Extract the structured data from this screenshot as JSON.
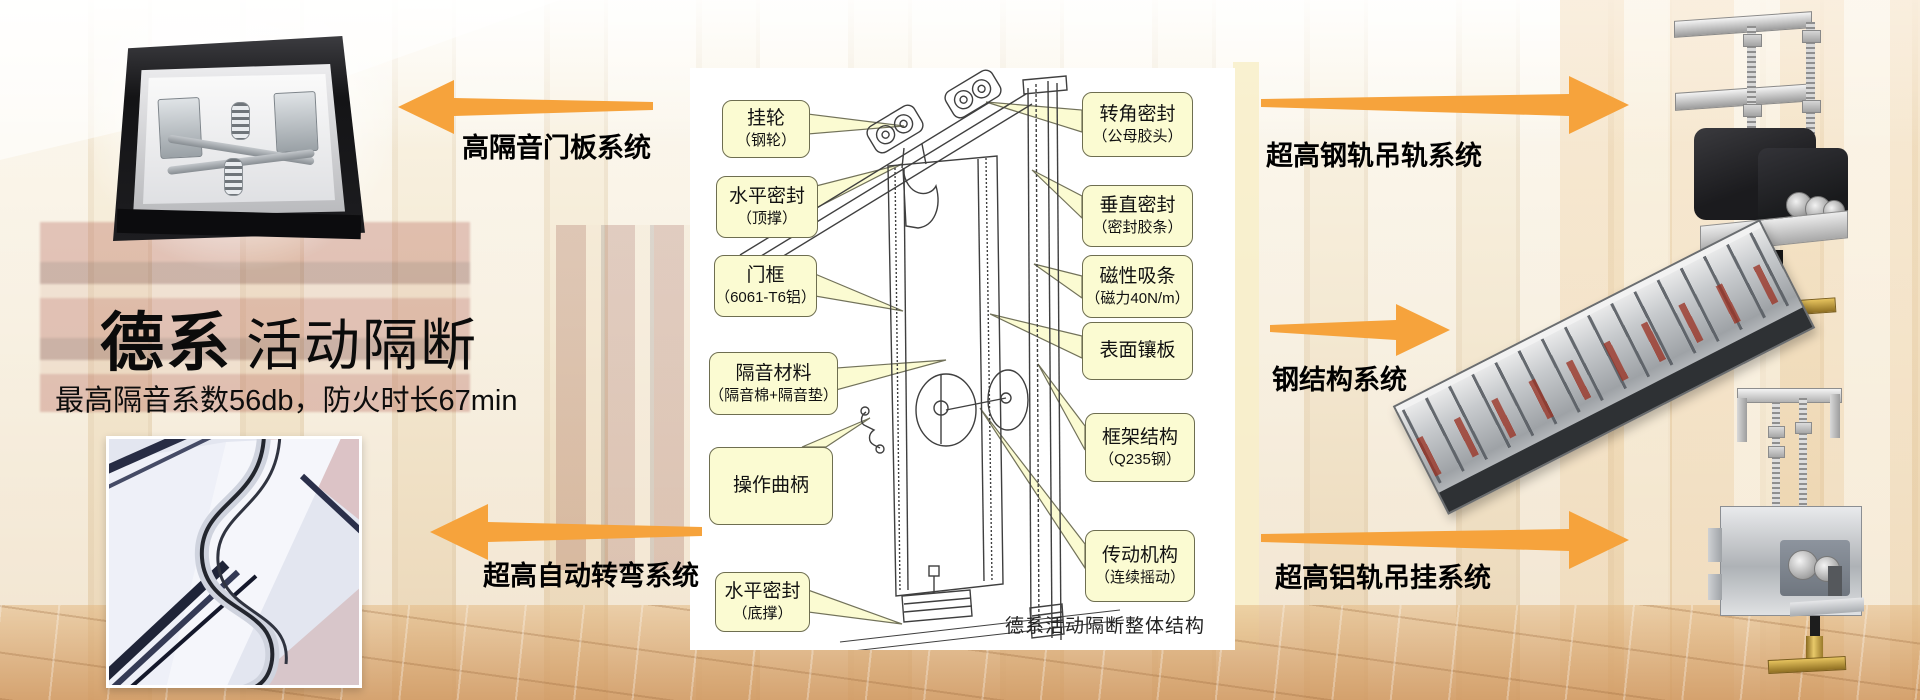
{
  "brand": {
    "title_primary": "德系",
    "title_secondary": "活动隔断",
    "subtitle": "最高隔音系数56db，防火时长67min"
  },
  "system_arrows": {
    "top_left": "高隔音门板系统",
    "bottom_left": "超高自动转弯系统",
    "top_right": "超高钢轨吊轨系统",
    "mid_right": "钢结构系统",
    "bottom_right": "超高铝轨吊挂系统"
  },
  "diagram": {
    "caption": "德系活动隔断整体结构",
    "left_labels": [
      {
        "line1": "挂轮",
        "line2": "（钢轮）"
      },
      {
        "line1": "水平密封",
        "line2": "（顶撑）"
      },
      {
        "line1": "门框",
        "line2": "（6061-T6铝）"
      },
      {
        "line1": "隔音材料",
        "line2": "（隔音棉+隔音垫）"
      },
      {
        "line1": "操作曲柄",
        "line2": ""
      },
      {
        "line1": "水平密封",
        "line2": "（底撑）"
      }
    ],
    "right_labels": [
      {
        "line1": "转角密封",
        "line2": "（公母胶头）"
      },
      {
        "line1": "垂直密封",
        "line2": "（密封胶条）"
      },
      {
        "line1": "磁性吸条",
        "line2": "（磁力40N/m）"
      },
      {
        "line1": "表面镶板",
        "line2": ""
      },
      {
        "line1": "框架结构",
        "line2": "（Q235钢）"
      },
      {
        "line1": "传动机构",
        "line2": "（连续摇动）"
      }
    ]
  },
  "colors": {
    "arrow_orange": "#F6A33C",
    "callout_fill": "#FBFBD2",
    "callout_border": "#6E6E50"
  }
}
